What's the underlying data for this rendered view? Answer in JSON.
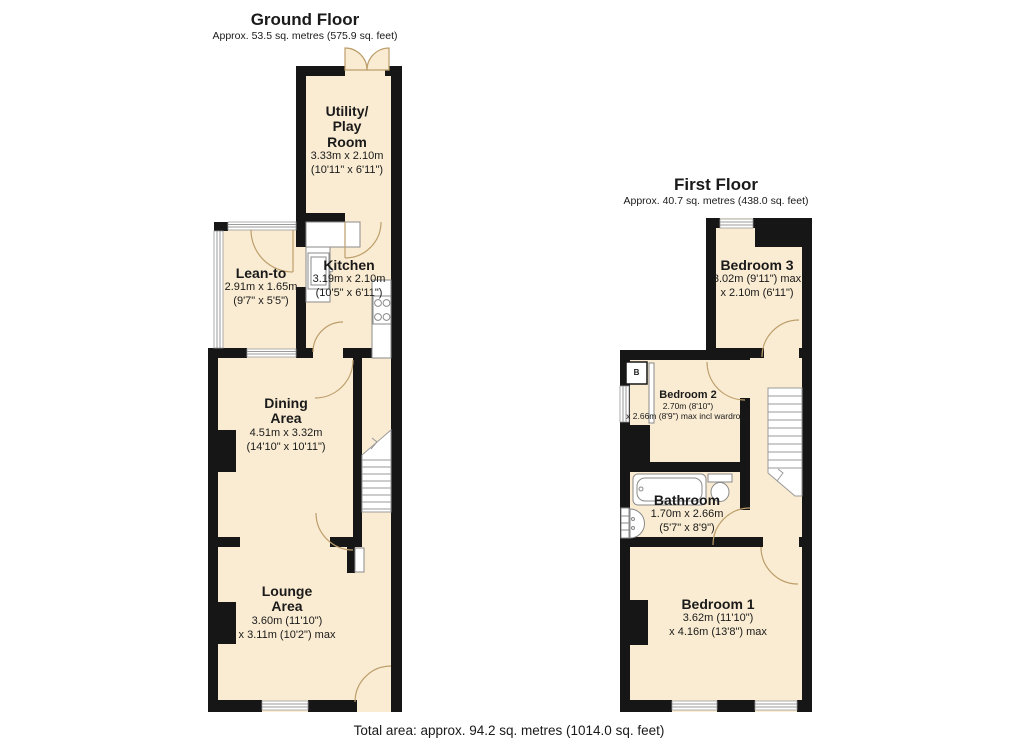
{
  "colors": {
    "room": "#faecd2",
    "wall": "#161616",
    "arc": "#bd9e6b",
    "fixture": "#8a8a8a",
    "step": "#9a9a9a",
    "win": "#9a9a9a"
  },
  "footer": {
    "total_area": "Total area: approx. 94.2 sq. metres (1014.0 sq. feet)"
  },
  "ground_floor": {
    "title": "Ground Floor",
    "subtitle": "Approx. 53.5 sq. metres (575.9 sq. feet)",
    "rooms": {
      "utility": {
        "name1": "Utility/",
        "name2": "Play",
        "name3": "Room",
        "dim1": "3.33m x 2.10m",
        "dim2": "(10'11\" x 6'11\")"
      },
      "leanto": {
        "name1": "Lean-to",
        "dim1": "2.91m x 1.65m",
        "dim2": "(9'7\" x 5'5\")"
      },
      "kitchen": {
        "name1": "Kitchen",
        "dim1": "3.19m x 2.10m",
        "dim2": "(10'5\" x 6'11\")"
      },
      "dining": {
        "name1": "Dining",
        "name2": "Area",
        "dim1": "4.51m x 3.32m",
        "dim2": "(14'10\" x 10'11\")"
      },
      "lounge": {
        "name1": "Lounge",
        "name2": "Area",
        "dim1": "3.60m (11'10\")",
        "dim2": "x 3.11m (10'2\") max"
      }
    }
  },
  "first_floor": {
    "title": "First Floor",
    "subtitle": "Approx. 40.7 sq. metres (438.0 sq. feet)",
    "rooms": {
      "bedroom3": {
        "name1": "Bedroom 3",
        "dim1": "3.02m (9'11\") max",
        "dim2": "x 2.10m (6'11\")"
      },
      "bedroom2": {
        "name1": "Bedroom 2",
        "dim1": "2.70m (8'10\")",
        "dim2": "x 2.66m (8'9\") max incl wardrobe"
      },
      "bathroom": {
        "name1": "Bathroom",
        "dim1": "1.70m x 2.66m",
        "dim2": "(5'7\" x 8'9\")"
      },
      "bedroom1": {
        "name1": "Bedroom 1",
        "dim1": "3.62m (11'10\")",
        "dim2": "x 4.16m (13'8\") max"
      },
      "boiler": {
        "label": "B"
      }
    }
  }
}
